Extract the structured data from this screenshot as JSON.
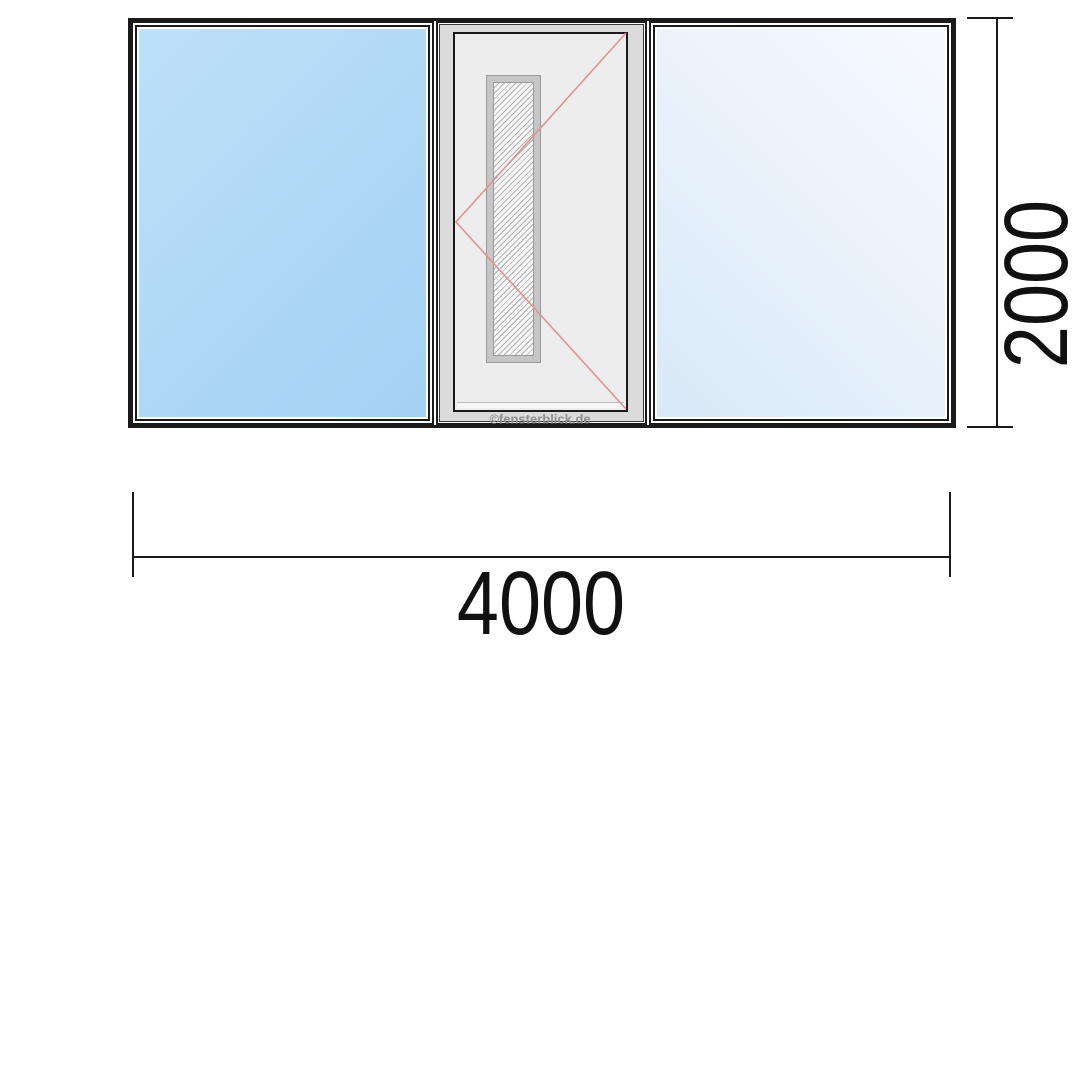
{
  "dimensions": {
    "width": {
      "value": "4000"
    },
    "height": {
      "value": "2000"
    }
  },
  "watermark": {
    "text": "©fensterblick.de"
  },
  "colors": {
    "line": "#1a1a1a",
    "glass_left_start": "#bde0fa",
    "glass_left_end": "#a4d1f3",
    "glass_right_start": "#f7fafe",
    "glass_right_end": "#d9e9f8",
    "door_surround": "#dbdbdb",
    "door_leaf": "#ededed",
    "strip_frame": "#c6c6c6",
    "hatch": "#b2b2b2",
    "opening_symbol": "#e39191",
    "watermark_color": "#8f8f8f"
  }
}
